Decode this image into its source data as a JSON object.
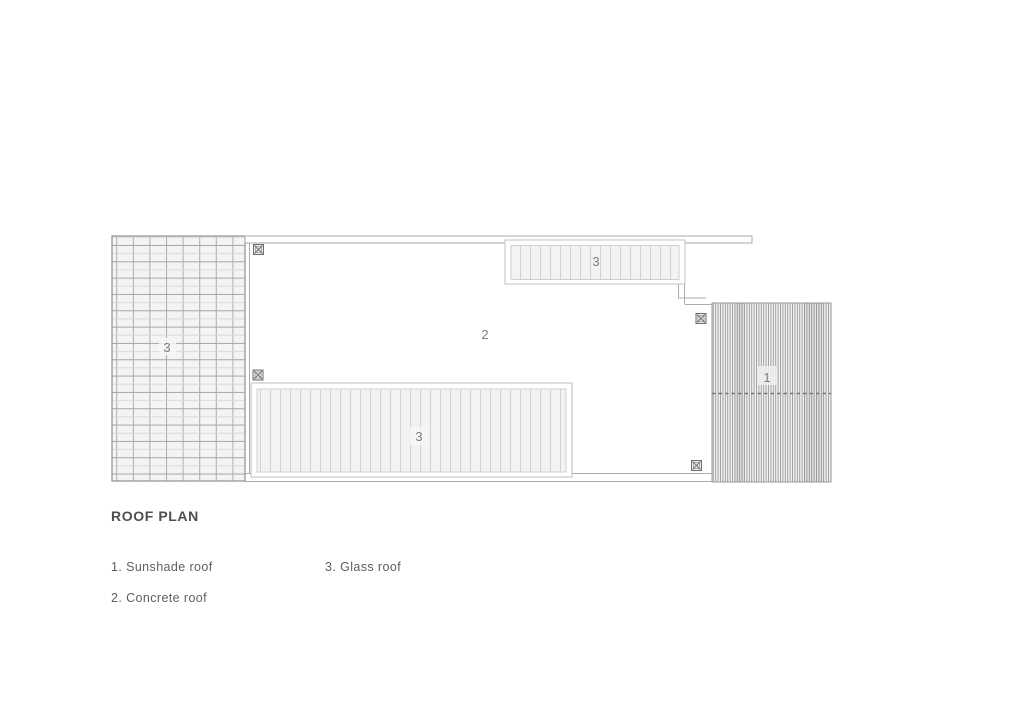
{
  "title": "ROOF PLAN",
  "legend": {
    "items": [
      {
        "label": "1. Sunshade roof"
      },
      {
        "label": "2. Concrete roof"
      },
      {
        "label": "3. Glass roof"
      }
    ]
  },
  "plan": {
    "labels": {
      "sunshade": "1",
      "concrete": "2",
      "glass_left": "3",
      "glass_top": "3",
      "glass_bottom": "3"
    },
    "icons": {
      "column_marker": "crossed-square-icon"
    },
    "colors": {
      "title_ink": "#4f4f4f",
      "legend_ink": "#5f5f5f",
      "label_ink": "#7d7d7d",
      "outline_gray": "#a8a8a8",
      "grid_line": "#a9a9a9",
      "hatch_line": "#d2d2d2",
      "dense_hatch_line": "#9a9a9a",
      "fill_light": "#f3f3f3"
    }
  }
}
